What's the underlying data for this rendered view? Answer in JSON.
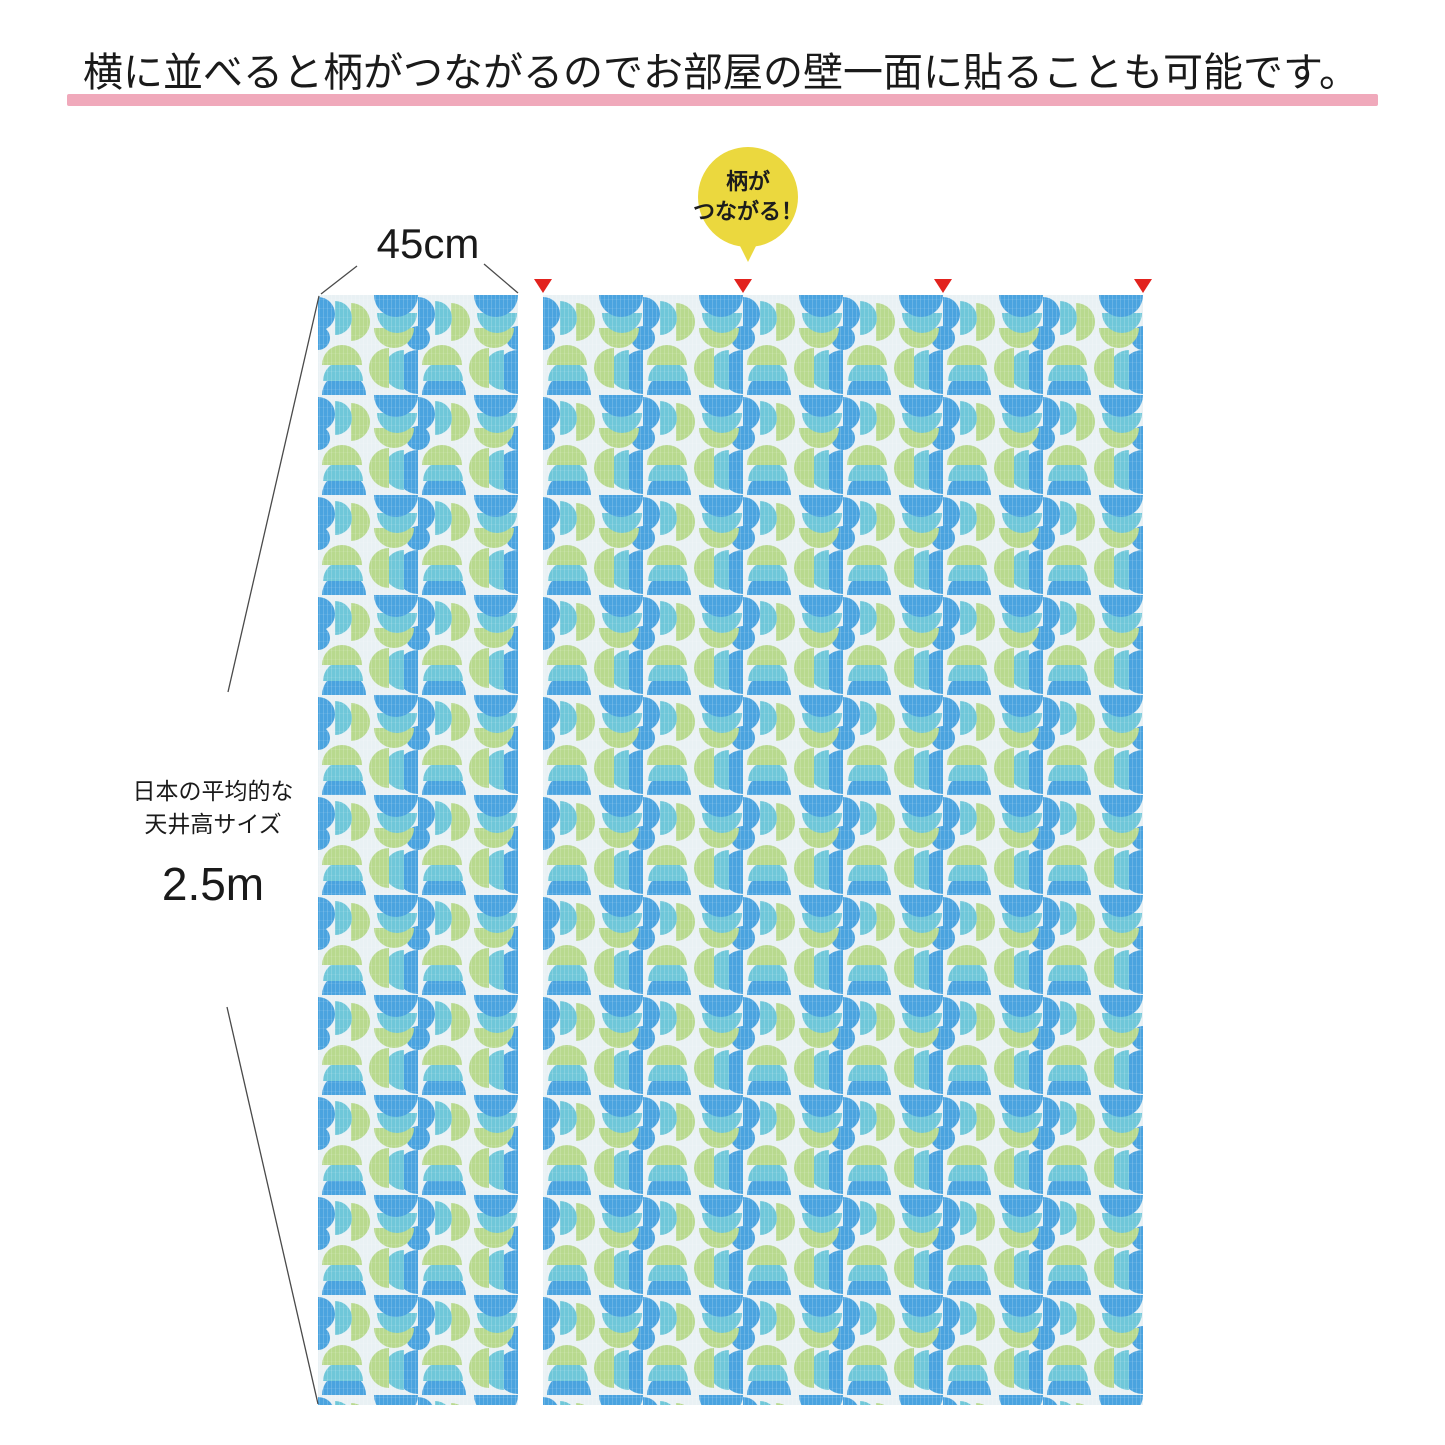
{
  "headline": {
    "text": "横に並べると柄がつながるのでお部屋の壁一面に貼ることも可能です。"
  },
  "badge": {
    "line1": "柄が",
    "line2": "つながる！"
  },
  "dimensions": {
    "width_label": "45cm",
    "height_caption_line1": "日本の平均的な",
    "height_caption_line2": "天井高サイズ",
    "height_value": "2.5m"
  },
  "colors": {
    "headline_text": "#1a1a1a",
    "underline_pink": "#f0a9bb",
    "badge_yellow": "#ebd83e",
    "badge_text": "#1c1c1c",
    "marker_red": "#e2231e",
    "dimension_line": "#4a4a4a",
    "wallpaper_blue": "#4aa3df",
    "wallpaper_cyan": "#6fc7d9",
    "wallpaper_green": "#b8d98e",
    "wallpaper_bg": "#e9f1f4"
  }
}
